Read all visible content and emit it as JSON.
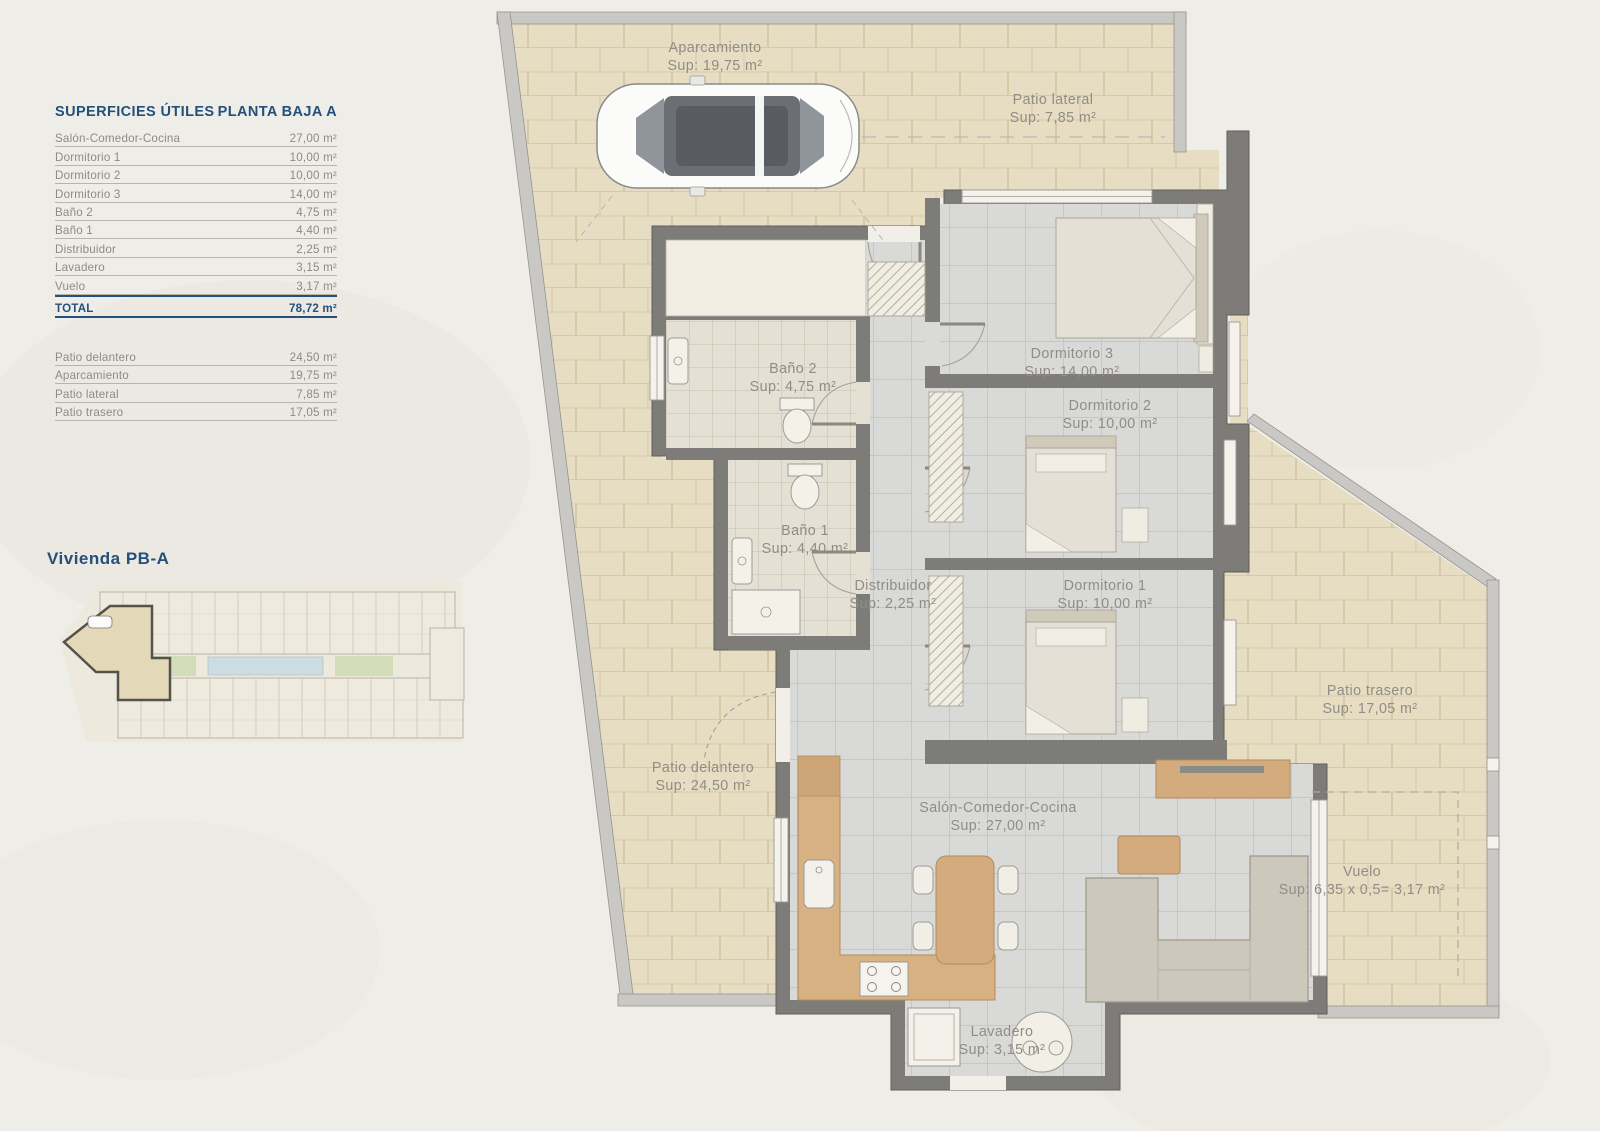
{
  "table": {
    "header": {
      "left": "SUPERFICIES ÚTILES",
      "right": "PLANTA BAJA A"
    },
    "rows": [
      {
        "label": "Salón-Comedor-Cocina",
        "value": "27,00 m²"
      },
      {
        "label": "Dormitorio 1",
        "value": "10,00 m²"
      },
      {
        "label": "Dormitorio 2",
        "value": "10,00 m²"
      },
      {
        "label": "Dormitorio 3",
        "value": "14,00 m²"
      },
      {
        "label": "Baño 2",
        "value": "4,75 m²"
      },
      {
        "label": "Baño 1",
        "value": "4,40 m²"
      },
      {
        "label": "Distribuidor",
        "value": "2,25 m²"
      },
      {
        "label": "Lavadero",
        "value": "3,15 m²"
      },
      {
        "label": "Vuelo",
        "value": "3,17 m²"
      }
    ],
    "total": {
      "label": "TOTAL",
      "value": "78,72 m²"
    },
    "outdoor_rows": [
      {
        "label": "Patio delantero",
        "value": "24,50 m²"
      },
      {
        "label": "Aparcamiento",
        "value": "19,75 m²"
      },
      {
        "label": "Patio lateral",
        "value": "7,85 m²"
      },
      {
        "label": "Patio trasero",
        "value": "17,05 m²"
      }
    ]
  },
  "site_plan": {
    "title": "Vivienda PB-A"
  },
  "plan": {
    "rooms": [
      {
        "id": "aparcamiento",
        "name": "Aparcamiento",
        "sup": "Sup: 19,75 m²"
      },
      {
        "id": "patio-lateral",
        "name": "Patio lateral",
        "sup": "Sup: 7,85 m²"
      },
      {
        "id": "dormitorio-3",
        "name": "Dormitorio 3",
        "sup": "Sup: 14,00 m²"
      },
      {
        "id": "dormitorio-2",
        "name": "Dormitorio 2",
        "sup": "Sup: 10,00 m²"
      },
      {
        "id": "bano-2",
        "name": "Baño 2",
        "sup": "Sup: 4,75 m²"
      },
      {
        "id": "bano-1",
        "name": "Baño 1",
        "sup": "Sup: 4,40 m²"
      },
      {
        "id": "distribuidor",
        "name": "Distribuidor",
        "sup": "Sup: 2,25 m²"
      },
      {
        "id": "dormitorio-1",
        "name": "Dormitorio 1",
        "sup": "Sup: 10,00 m²"
      },
      {
        "id": "patio-delantero",
        "name": "Patio delantero",
        "sup": "Sup: 24,50 m²"
      },
      {
        "id": "salon",
        "name": "Salón-Comedor-Cocina",
        "sup": "Sup: 27,00 m²"
      },
      {
        "id": "patio-trasero",
        "name": "Patio trasero",
        "sup": "Sup: 17,05 m²"
      },
      {
        "id": "vuelo",
        "name": "Vuelo",
        "sup": "Sup: 6,35 x 0,5= 3,17 m²"
      },
      {
        "id": "lavadero",
        "name": "Lavadero",
        "sup": "Sup: 3,15 m²"
      }
    ]
  },
  "colors": {
    "accent_blue": "#24507c",
    "label_gray": "#8f8d85",
    "beige_tile": "#e7ddc3",
    "interior_tile": "#d9d9d8",
    "wall_dark": "#7d7c78",
    "wall_light": "#c9c8c5",
    "wood": "#d4ac7d"
  }
}
